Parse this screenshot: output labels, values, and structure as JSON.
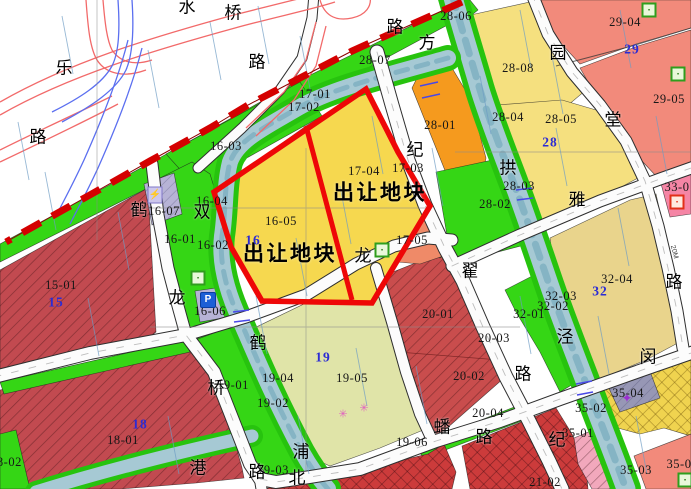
{
  "map": {
    "title_note": "land transfer plot planning map",
    "callout_text": "出让地块",
    "colors": {
      "boundary_dashed": "#d40000",
      "transfer_outline": "#ee0707",
      "greenery": "#35d615",
      "river": "#a6c9d4",
      "road": "#fcfcfc",
      "yellow_plot": "#f6d84f",
      "orange_plot": "#f59a1e",
      "salmon_plot": "#f28a7b",
      "dark_red_plot": "#c24a50",
      "olive_plot": "#e0e4a8",
      "khaki_plot": "#e9d48c",
      "pink_plot": "#f585a5",
      "gray_plot": "#9797b5",
      "zone_number_blue": "#2b2bd4"
    },
    "labels": [
      {
        "name": "callout-transfer-1",
        "text": "出让地块",
        "x": 380,
        "y": 193,
        "cls": "c"
      },
      {
        "name": "callout-transfer-2",
        "text": "出让地块",
        "x": 290,
        "y": 254,
        "cls": "c"
      },
      {
        "name": "parcel-label-15-01",
        "text": "15-01",
        "x": 61,
        "y": 285,
        "cls": "p"
      },
      {
        "name": "parcel-label-16-01",
        "text": "16-01",
        "x": 180,
        "y": 239,
        "cls": "p"
      },
      {
        "name": "parcel-label-16-02",
        "text": "16-02",
        "x": 213,
        "y": 245,
        "cls": "p"
      },
      {
        "name": "parcel-label-16-03",
        "text": "16-03",
        "x": 226,
        "y": 146,
        "cls": "p"
      },
      {
        "name": "parcel-label-16-04",
        "text": "16-04",
        "x": 212,
        "y": 201,
        "cls": "p"
      },
      {
        "name": "parcel-label-16-05",
        "text": "16-05",
        "x": 281,
        "y": 221,
        "cls": "p"
      },
      {
        "name": "parcel-label-16-06",
        "text": "16-06",
        "x": 210,
        "y": 311,
        "cls": "p"
      },
      {
        "name": "parcel-label-16-07",
        "text": "16-07",
        "x": 164,
        "y": 211,
        "cls": "p"
      },
      {
        "name": "parcel-label-17-01",
        "text": "17-01",
        "x": 315,
        "y": 94,
        "cls": "p"
      },
      {
        "name": "parcel-label-17-02",
        "text": "17-02",
        "x": 304,
        "y": 107,
        "cls": "p"
      },
      {
        "name": "parcel-label-17-03",
        "text": "17-03",
        "x": 408,
        "y": 168,
        "cls": "p"
      },
      {
        "name": "parcel-label-17-04",
        "text": "17-04",
        "x": 364,
        "y": 171,
        "cls": "p"
      },
      {
        "name": "parcel-label-17-05",
        "text": "17-05",
        "x": 412,
        "y": 240,
        "cls": "p"
      },
      {
        "name": "parcel-label-18-01",
        "text": "18-01",
        "x": 123,
        "y": 440,
        "cls": "p"
      },
      {
        "name": "parcel-label-18-02",
        "text": "18-02",
        "x": 6,
        "y": 462,
        "cls": "p"
      },
      {
        "name": "parcel-label-19-01",
        "text": "19-01",
        "x": 233,
        "y": 385,
        "cls": "p"
      },
      {
        "name": "parcel-label-19-02",
        "text": "19-02",
        "x": 273,
        "y": 403,
        "cls": "p"
      },
      {
        "name": "parcel-label-19-03",
        "text": "19-03",
        "x": 273,
        "y": 470,
        "cls": "p"
      },
      {
        "name": "parcel-label-19-04",
        "text": "19-04",
        "x": 278,
        "y": 378,
        "cls": "p"
      },
      {
        "name": "parcel-label-19-05",
        "text": "19-05",
        "x": 352,
        "y": 378,
        "cls": "p"
      },
      {
        "name": "parcel-label-19-06",
        "text": "19-06",
        "x": 412,
        "y": 442,
        "cls": "p"
      },
      {
        "name": "parcel-label-20-01",
        "text": "20-01",
        "x": 438,
        "y": 314,
        "cls": "p"
      },
      {
        "name": "parcel-label-20-02",
        "text": "20-02",
        "x": 469,
        "y": 376,
        "cls": "p"
      },
      {
        "name": "parcel-label-20-03",
        "text": "20-03",
        "x": 494,
        "y": 338,
        "cls": "p"
      },
      {
        "name": "parcel-label-20-04",
        "text": "20-04",
        "x": 488,
        "y": 413,
        "cls": "p"
      },
      {
        "name": "parcel-label-21-02",
        "text": "21-02",
        "x": 545,
        "y": 482,
        "cls": "p"
      },
      {
        "name": "parcel-label-28-01",
        "text": "28-01",
        "x": 440,
        "y": 125,
        "cls": "p"
      },
      {
        "name": "parcel-label-28-02",
        "text": "28-02",
        "x": 495,
        "y": 204,
        "cls": "p"
      },
      {
        "name": "parcel-label-28-03",
        "text": "28-03",
        "x": 519,
        "y": 186,
        "cls": "p"
      },
      {
        "name": "parcel-label-28-04",
        "text": "28-04",
        "x": 508,
        "y": 117,
        "cls": "p"
      },
      {
        "name": "parcel-label-28-05",
        "text": "28-05",
        "x": 561,
        "y": 119,
        "cls": "p"
      },
      {
        "name": "parcel-label-28-06",
        "text": "28-06",
        "x": 456,
        "y": 16,
        "cls": "p"
      },
      {
        "name": "parcel-label-28-07",
        "text": "28-07",
        "x": 375,
        "y": 60,
        "cls": "p"
      },
      {
        "name": "parcel-label-28-08",
        "text": "28-08",
        "x": 518,
        "y": 68,
        "cls": "p"
      },
      {
        "name": "parcel-label-29-04",
        "text": "29-04",
        "x": 625,
        "y": 22,
        "cls": "p"
      },
      {
        "name": "parcel-label-29-05",
        "text": "29-05",
        "x": 669,
        "y": 99,
        "cls": "p"
      },
      {
        "name": "parcel-label-32-01",
        "text": "32-01",
        "x": 529,
        "y": 314,
        "cls": "p"
      },
      {
        "name": "parcel-label-32-02",
        "text": "32-02",
        "x": 553,
        "y": 306,
        "cls": "p"
      },
      {
        "name": "parcel-label-32-03",
        "text": "32-03",
        "x": 561,
        "y": 296,
        "cls": "p"
      },
      {
        "name": "parcel-label-32-04",
        "text": "32-04",
        "x": 617,
        "y": 279,
        "cls": "p"
      },
      {
        "name": "parcel-label-33-0",
        "text": "33-0",
        "x": 677,
        "y": 187,
        "cls": "p"
      },
      {
        "name": "parcel-label-35-01",
        "text": "35-01",
        "x": 578,
        "y": 433,
        "cls": "p"
      },
      {
        "name": "parcel-label-35-02",
        "text": "35-02",
        "x": 591,
        "y": 408,
        "cls": "p"
      },
      {
        "name": "parcel-label-35-03",
        "text": "35-03",
        "x": 636,
        "y": 470,
        "cls": "p"
      },
      {
        "name": "parcel-label-35-04",
        "text": "35-04",
        "x": 628,
        "y": 393,
        "cls": "p"
      },
      {
        "name": "parcel-label-35-0",
        "text": "35-0",
        "x": 679,
        "y": 464,
        "cls": "p"
      },
      {
        "name": "zone-number-15",
        "text": "15",
        "x": 56,
        "y": 302,
        "cls": "z"
      },
      {
        "name": "zone-number-16",
        "text": "16",
        "x": 253,
        "y": 240,
        "cls": "z"
      },
      {
        "name": "zone-number-18",
        "text": "18",
        "x": 140,
        "y": 424,
        "cls": "z"
      },
      {
        "name": "zone-number-19",
        "text": "19",
        "x": 323,
        "y": 357,
        "cls": "z"
      },
      {
        "name": "zone-number-28",
        "text": "28",
        "x": 550,
        "y": 142,
        "cls": "z"
      },
      {
        "name": "zone-number-29",
        "text": "29",
        "x": 632,
        "y": 49,
        "cls": "z"
      },
      {
        "name": "zone-number-32",
        "text": "32",
        "x": 600,
        "y": 291,
        "cls": "z"
      },
      {
        "name": "road-char-shui",
        "text": "水",
        "x": 187,
        "y": 7,
        "cls": "r"
      },
      {
        "name": "road-char-qiao-1",
        "text": "桥",
        "x": 233,
        "y": 13,
        "cls": "r"
      },
      {
        "name": "road-char-lu-1",
        "text": "路",
        "x": 257,
        "y": 62,
        "cls": "r"
      },
      {
        "name": "road-char-le",
        "text": "乐",
        "x": 64,
        "y": 68,
        "cls": "r"
      },
      {
        "name": "road-char-lu-2",
        "text": "路",
        "x": 38,
        "y": 137,
        "cls": "r"
      },
      {
        "name": "road-char-lu-3",
        "text": "路",
        "x": 395,
        "y": 27,
        "cls": "r"
      },
      {
        "name": "road-char-fang",
        "text": "方",
        "x": 427,
        "y": 43,
        "cls": "r"
      },
      {
        "name": "road-char-ji-1",
        "text": "纪",
        "x": 415,
        "y": 150,
        "cls": "r"
      },
      {
        "name": "road-char-di",
        "text": "翟",
        "x": 470,
        "y": 271,
        "cls": "r"
      },
      {
        "name": "road-char-lu-4",
        "text": "路",
        "x": 523,
        "y": 374,
        "cls": "r"
      },
      {
        "name": "road-char-yuan",
        "text": "园",
        "x": 558,
        "y": 53,
        "cls": "r"
      },
      {
        "name": "road-char-tang",
        "text": "堂",
        "x": 613,
        "y": 120,
        "cls": "r"
      },
      {
        "name": "road-char-ya",
        "text": "雅",
        "x": 577,
        "y": 200,
        "cls": "r"
      },
      {
        "name": "road-char-gong",
        "text": "拱",
        "x": 508,
        "y": 168,
        "cls": "r"
      },
      {
        "name": "road-char-shuang",
        "text": "双",
        "x": 202,
        "y": 212,
        "cls": "r"
      },
      {
        "name": "road-char-he-1",
        "text": "鹤",
        "x": 139,
        "y": 210,
        "cls": "r"
      },
      {
        "name": "road-char-long-1",
        "text": "龙",
        "x": 177,
        "y": 298,
        "cls": "r"
      },
      {
        "name": "road-char-long-2",
        "text": "龙",
        "x": 363,
        "y": 256,
        "cls": "r"
      },
      {
        "name": "road-char-he-2",
        "text": "鹤",
        "x": 258,
        "y": 343,
        "cls": "r"
      },
      {
        "name": "road-char-pu",
        "text": "浦",
        "x": 301,
        "y": 452,
        "cls": "r"
      },
      {
        "name": "road-char-gang",
        "text": "港",
        "x": 198,
        "y": 468,
        "cls": "r"
      },
      {
        "name": "road-char-qiao-2",
        "text": "桥",
        "x": 216,
        "y": 388,
        "cls": "r"
      },
      {
        "name": "road-char-lu-5",
        "text": "路",
        "x": 257,
        "y": 472,
        "cls": "r"
      },
      {
        "name": "road-char-bei",
        "text": "北",
        "x": 297,
        "y": 478,
        "cls": "r"
      },
      {
        "name": "road-char-pan",
        "text": "蟠",
        "x": 442,
        "y": 427,
        "cls": "r"
      },
      {
        "name": "road-char-lu-6",
        "text": "路",
        "x": 484,
        "y": 437,
        "cls": "r"
      },
      {
        "name": "road-char-jing",
        "text": "泾",
        "x": 565,
        "y": 337,
        "cls": "r"
      },
      {
        "name": "road-char-min",
        "text": "闵",
        "x": 648,
        "y": 357,
        "cls": "r"
      },
      {
        "name": "road-char-ji-2",
        "text": "纪",
        "x": 557,
        "y": 440,
        "cls": "r"
      },
      {
        "name": "road-char-lu-7",
        "text": "路",
        "x": 674,
        "y": 282,
        "cls": "r"
      },
      {
        "name": "road-width-note",
        "text": "20M",
        "x": 674,
        "y": 252,
        "cls": "t",
        "rot": 75
      }
    ],
    "icons": [
      {
        "name": "lightning-icon",
        "type": "lightning",
        "glyph": "⚡",
        "x": 155,
        "y": 195
      },
      {
        "name": "parking-icon",
        "type": "parking",
        "glyph": "P",
        "x": 208,
        "y": 300
      },
      {
        "name": "facility-icon-green-1",
        "type": "green",
        "glyph": "▪",
        "x": 649,
        "y": 10
      },
      {
        "name": "facility-icon-green-2",
        "type": "green",
        "glyph": "▪",
        "x": 678,
        "y": 74
      },
      {
        "name": "facility-icon-green-3",
        "type": "green",
        "glyph": "▪",
        "x": 198,
        "y": 278
      },
      {
        "name": "facility-icon-green-4",
        "type": "green",
        "glyph": "▪",
        "x": 382,
        "y": 250
      },
      {
        "name": "facility-icon-green-5",
        "type": "green",
        "glyph": "▪",
        "x": 685,
        "y": 480
      },
      {
        "name": "facility-icon-red",
        "type": "red",
        "glyph": "▪",
        "x": 677,
        "y": 202
      },
      {
        "name": "facility-icon-purple",
        "type": "star",
        "glyph": "✦",
        "x": 627,
        "y": 398
      },
      {
        "name": "flower-icon-1",
        "type": "flower",
        "glyph": "✳",
        "x": 343,
        "y": 415
      },
      {
        "name": "flower-icon-2",
        "type": "flower",
        "glyph": "✳",
        "x": 364,
        "y": 409
      }
    ]
  }
}
